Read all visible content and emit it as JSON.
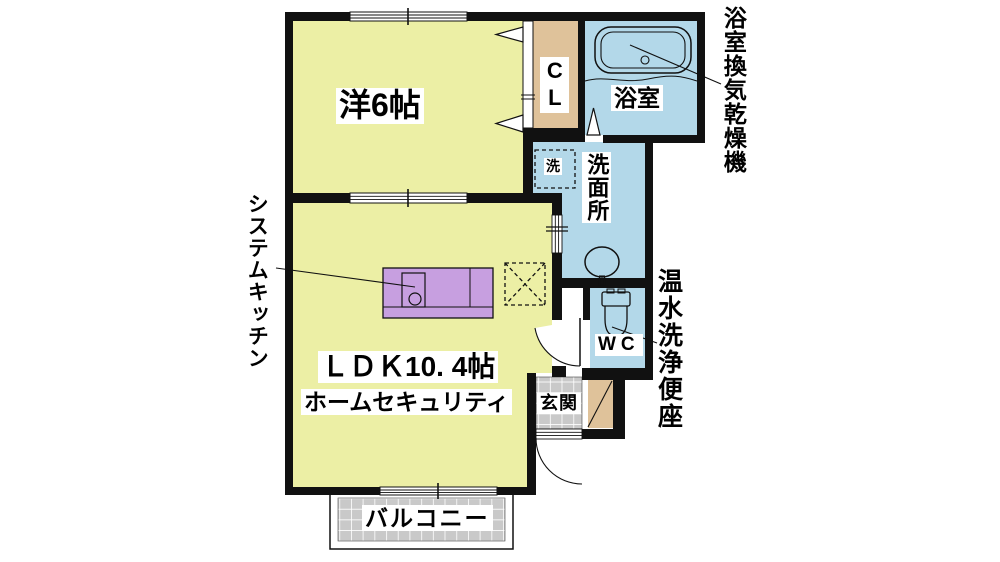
{
  "rooms": {
    "western": {
      "label": "洋6帖"
    },
    "closet": {
      "label": "CL"
    },
    "bathroom": {
      "label": "浴室"
    },
    "washroom": {
      "label": "洗面所"
    },
    "washer_space": {
      "label": "洗"
    },
    "wc": {
      "label": "WC"
    },
    "ldk": {
      "label": "ＬＤＫ10. 4帖"
    },
    "security": {
      "label": "ホームセキュリティ"
    },
    "entrance": {
      "label": "玄関"
    },
    "balcony": {
      "label": "バルコニー"
    }
  },
  "annotations": {
    "system_kitchen": "システムキッチン",
    "bathroom_dryer": "浴室換気乾燥機",
    "washlet": "温水洗浄便座"
  },
  "colors": {
    "room_yellow": "#ecefa5",
    "water_blue": "#b3d8e9",
    "closet_beige": "#dfc29a",
    "kitchen_purple": "#c79fe0",
    "tile_gray": "#c9c9c9",
    "wall_black": "#111111"
  }
}
